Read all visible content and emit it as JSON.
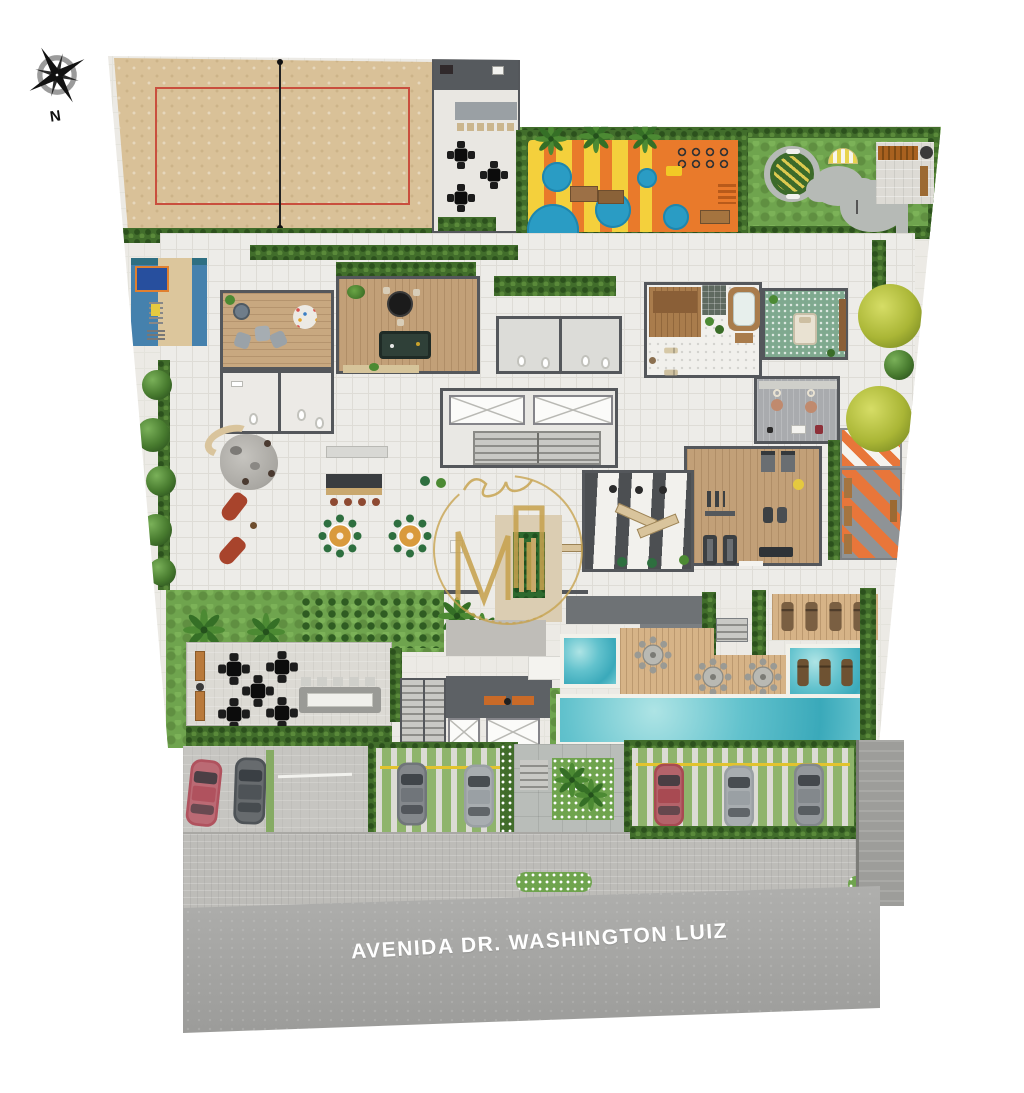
{
  "site": {
    "street_name": "AVENIDA DR. WASHINGTON LUIZ",
    "compass_label": "N"
  },
  "colors": {
    "background": "#ffffff",
    "sand": "#d9c198",
    "court_line": "#c94f3e",
    "playground_yellow": "#f4d03c",
    "playground_orange": "#e97a2b",
    "playground_blue": "#2a9cc4",
    "lawn_green": "#6fa44e",
    "hedge_green": "#416d2b",
    "pool_water": "#52bcca",
    "deck_wood": "#d6b387",
    "wall_gray": "#54575b",
    "floor_pale": "#edece8",
    "fitness_orange": "#e8763a",
    "street_asphalt": "#a2a2a0",
    "sidewalk_gray": "#bdbcb8",
    "logo_gold": "#c7a24e",
    "car_red": "#b0525e",
    "car_dark": "#4e5357",
    "car_silver": "#9aa0a4"
  }
}
